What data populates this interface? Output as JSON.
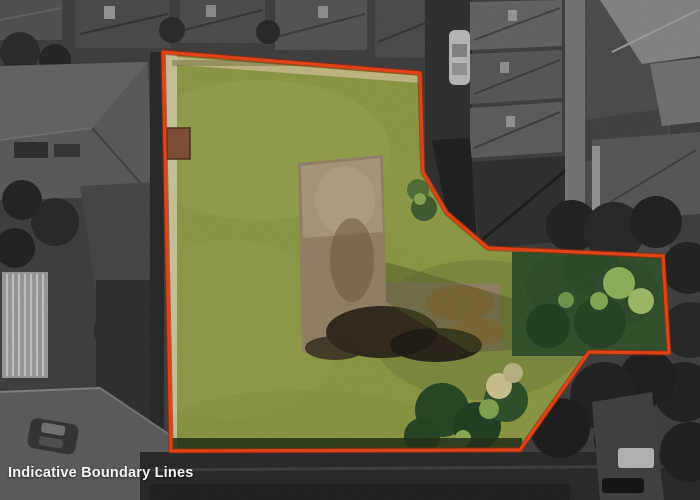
{
  "caption": {
    "text": "Indicative Boundary Lines"
  },
  "boundary": {
    "points": "163,52 420,73 423,172 447,213 488,248 663,256 669,353 589,352 520,450 171,451",
    "color": "#e23d10",
    "underlay_color": "#8f2406",
    "style": "solid"
  },
  "colors": {
    "grass": "#87933f",
    "grass_light": "#99a54c",
    "grass_shadow": "#6b7a33",
    "dirt": "#8d7c60",
    "dirt_light": "#a59678",
    "dirt_dark": "#211c12",
    "dirt_orange": "#9a6c38",
    "tree_dark": "#2c4726",
    "tree_mid": "#3f5c2e",
    "tree_light": "#8cab57",
    "hedge": "#1c2a14",
    "path_tan": "#cfc5a4",
    "backdrop": "#2e2e2e",
    "caption_text": "#f2f2f2"
  },
  "scene": {
    "subject": "colored residential land parcel outlined in red over grayscale aerial neighborhood",
    "elements": [
      "grass-lawn",
      "dirt-excavation-L-shape",
      "tree-clusters",
      "boundary-outline",
      "grayscale-houses",
      "roads",
      "white-car",
      "white-van",
      "dark-sedan",
      "shed-roof"
    ]
  }
}
